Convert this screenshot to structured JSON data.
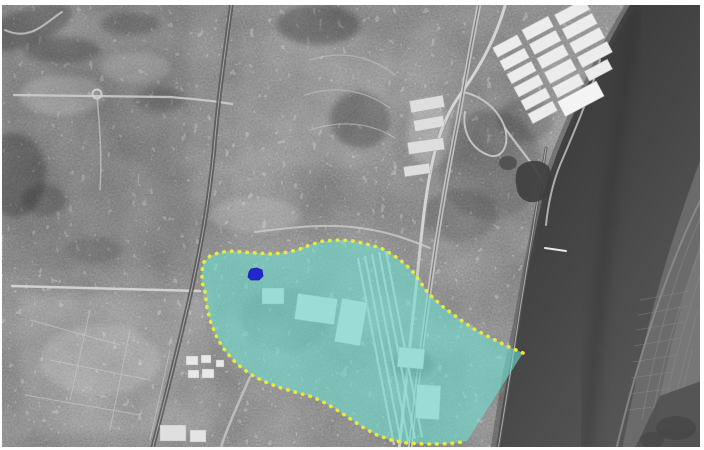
{
  "map": {
    "kind": "grayscale-aerial-photograph",
    "description": "Black-and-white aerial view of a riverside city: dense urban fabric on the left, a dark estuary along the right edge, white warehouse roofs in the top-right corner, and a riverfront industrial/rail district highlighted with a translucent cyan overlay bounded by a yellow dotted line; a small blue site marker sits near the north-west corner of the highlighted zone.",
    "frame_color": "#ffffff",
    "overlay": {
      "label": "highlighted-study-area",
      "fill_color": "#6ee1d2",
      "fill_opacity": "0.58",
      "border_color": "#ece73c",
      "border_style": "dotted",
      "points": "523,353 507,346 491,338 474,329 458,318 442,306 428,293 421,283 414,273 404,263 393,255 381,248 367,244 353,241 340,240 323,241 310,245 297,250 283,253 270,254 257,253 243,252 230,251 218,253 210,256 203,263 202,272 202,282 205,292 207,308 211,323 217,338 226,352 237,364 250,374 263,381 278,387 295,392 313,397 327,404 340,412 352,420 364,428 377,435 391,440 407,443 424,444 441,444 455,443 467,441",
      "border_path": "M523,353 L507,346 L491,338 L474,329 L458,318 L442,306 L428,293 L421,283 L414,273 L404,263 L393,255 L381,248 L367,244 L353,241 L340,240 L323,241 L310,245 L297,250 L283,253 L270,254 L257,253 L243,252 L230,251 L218,253 L210,256 L203,263 L202,272 L202,282 L205,292 L207,308 L211,323 L217,338 L226,352 L237,364 L250,374 L263,381 L278,387 L295,392 L313,397 L327,404 L340,412 L352,420 L364,428 L377,435 L391,440 L407,443 L424,444 L441,444 L455,443 L467,441"
    },
    "marker": {
      "label": "site-marker",
      "color": "#2626ce",
      "points": "249,272 251,269 257,268 262,270 263,276 259,280 251,280 248,277"
    }
  }
}
